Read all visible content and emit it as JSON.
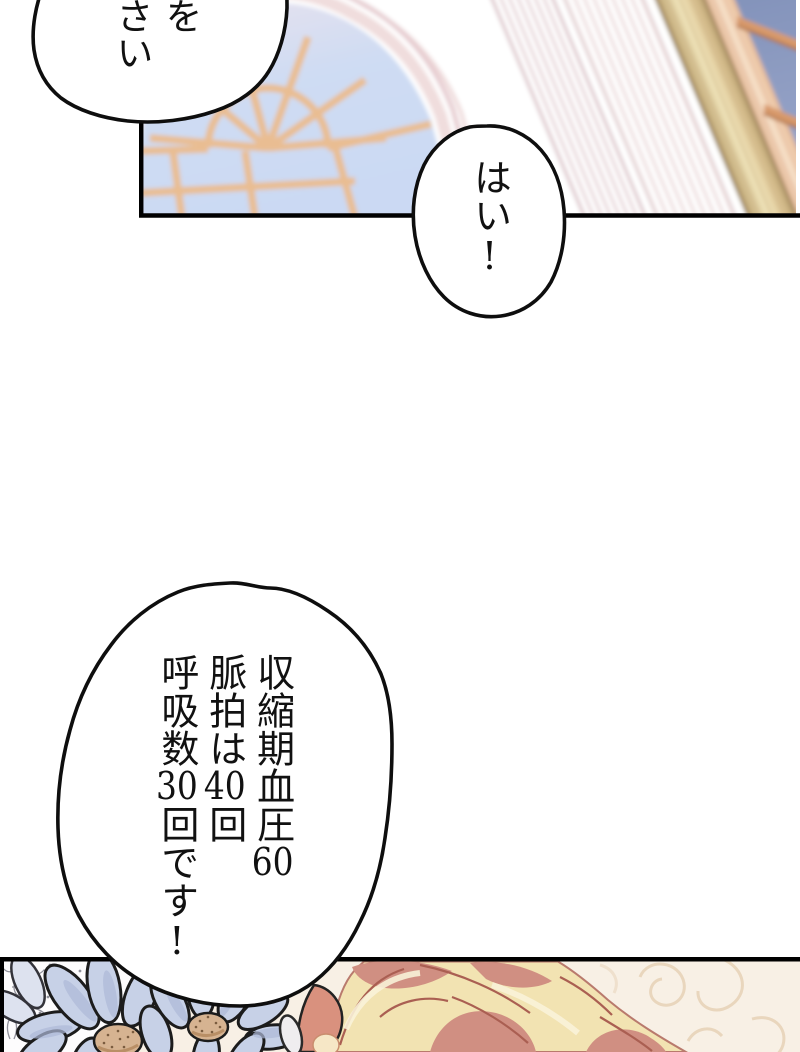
{
  "page": {
    "width": 800,
    "height": 1052,
    "background": "#ffffff"
  },
  "bubbles": {
    "top_left": {
      "text": "を\nさい"
    },
    "reply": {
      "text": "はい!"
    },
    "vitals": {
      "text": "収縮期血圧60\n脈拍は40回\n呼吸数30回です!"
    }
  },
  "colors": {
    "line": "#0e0e0e",
    "panel_border": "#000000",
    "bubble_fill": "#ffffff",
    "text": "#111111",
    "window_glass": "#cddcf3",
    "window_muntin": "#e9bd92",
    "arch_frame_pink": "#efdbdb",
    "pilaster_stripe": "#e3cdd1",
    "column_gold": "#e9d9ab",
    "column_peach": "#f6e3cd",
    "right_glass": "#8a9ac0",
    "right_muntin": "#d89a6c",
    "petal_blue": "#c7d1e7",
    "petal_shade": "#aeb9d8",
    "flower_center": "#d6b391",
    "lace_gray": "#90909a",
    "hair_gold": "#f2e3b2",
    "hair_highlight": "#f9f2d8",
    "hair_shadow": "#d08f82",
    "hair_line": "#aa5f52",
    "ribbon_rose": "#d9917e",
    "cream_background": "#f8f0e5",
    "swirl": "#e9d6bd"
  }
}
